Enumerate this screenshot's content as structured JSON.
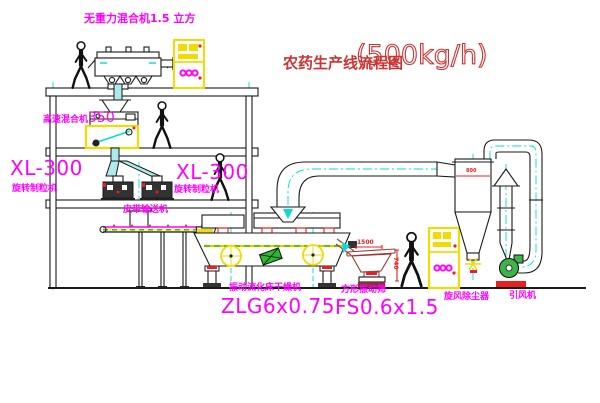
{
  "title": {
    "text": "农药生产线流程图",
    "capacity": "(500kg/h)"
  },
  "labels": {
    "gravity_mixer": "无重力混合机1.5 立方",
    "high_speed_mixer": {
      "name": "高速混合机",
      "model": "350"
    },
    "granulator_left": {
      "model": "XL-300",
      "name": "旋转制粒机"
    },
    "granulator_right": {
      "model": "XL-300",
      "name": "旋转制粒机"
    },
    "belt_conveyor": "皮带输送机",
    "fluid_bed_dryer": {
      "name": "振动流化床干燥机",
      "model": "ZLG6x0.75"
    },
    "square_sieve": {
      "name": "方形振动筛",
      "model": "FS0.6x1.5"
    },
    "cyclone": "旋风除尘器",
    "induced_draft_fan": "引风机"
  },
  "dimensions": {
    "sieve_length": "1500",
    "sieve_height": "740",
    "cyclone_diameter": "800"
  },
  "colors": {
    "label_magenta": "#ff00ff",
    "title_red": "#cc3333",
    "line_black": "#1a1a1a",
    "centerline_cyan": "#00dcdc",
    "highlight_yellow": "#f0dc00",
    "accent_red": "#e82020",
    "accent_green": "#00a32e",
    "sieve_red": "#9c3c34"
  }
}
